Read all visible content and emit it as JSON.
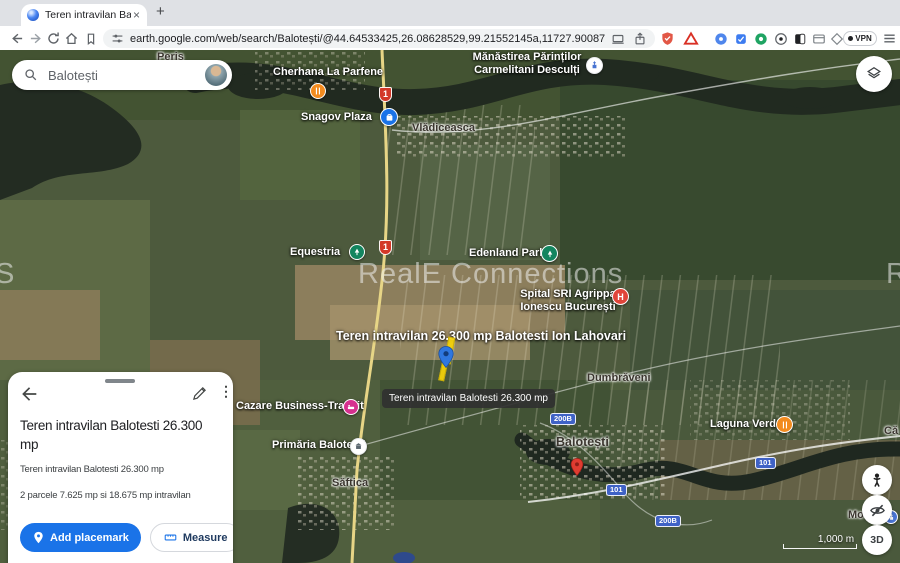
{
  "browser": {
    "tab_title": "Teren intravilan Balotesti 26…",
    "close_glyph": "×",
    "new_tab_glyph": "+",
    "url": "earth.google.com/web/search/Balotești/@44.64533425,26.08628529,99.21552145a,11727.90087684d,35y,-0h,0…",
    "vpn_label": "VPN"
  },
  "search": {
    "value": "Balotești"
  },
  "map": {
    "watermark": {
      "text": "RealE Connections",
      "partial_left": "S",
      "partial_right": "R"
    },
    "tooltip": "Teren intravilan Balotesti 26.300 mp",
    "scale_label": "1,000 m",
    "threed_label": "3D",
    "labels": [
      {
        "text": "Periş"
      },
      {
        "text": "Cherhana La Parfene"
      },
      {
        "lines": [
          "Mănăstirea Părinților",
          "Carmelitani Desculți"
        ]
      },
      {
        "text": "Snagov Plaza"
      },
      {
        "text": "Vlădiceasca"
      },
      {
        "text": "Equestria"
      },
      {
        "text": "Edenland Park"
      },
      {
        "lines": [
          "Spital SRI Agrippa",
          "Ionescu București"
        ]
      },
      {
        "text": "Teren intravilan  26.300 mp Balotesti Ion Lahovari"
      },
      {
        "text": "Dumbrăveni"
      },
      {
        "text": "Cazare Business-Transit"
      },
      {
        "text": "Primăria Balotești"
      },
      {
        "text": "Balotești"
      },
      {
        "text": "Laguna Verde"
      },
      {
        "text": "Săftica"
      },
      {
        "text": "Mo"
      },
      {
        "text": "Că"
      }
    ],
    "road_badges": [
      "1",
      "1",
      "200B",
      "101",
      "101",
      "200B"
    ]
  },
  "panel": {
    "title_lines": [
      "Teren intravilan Balotesti 26.300",
      "mp"
    ],
    "description_1": "Teren intravilan Balotesti 26.300 mp",
    "description_2": "2 parcele 7.625 mp si 18.675 mp intravilan",
    "add_placemark_label": "Add placemark",
    "measure_label": "Measure",
    "more_label": "More"
  }
}
